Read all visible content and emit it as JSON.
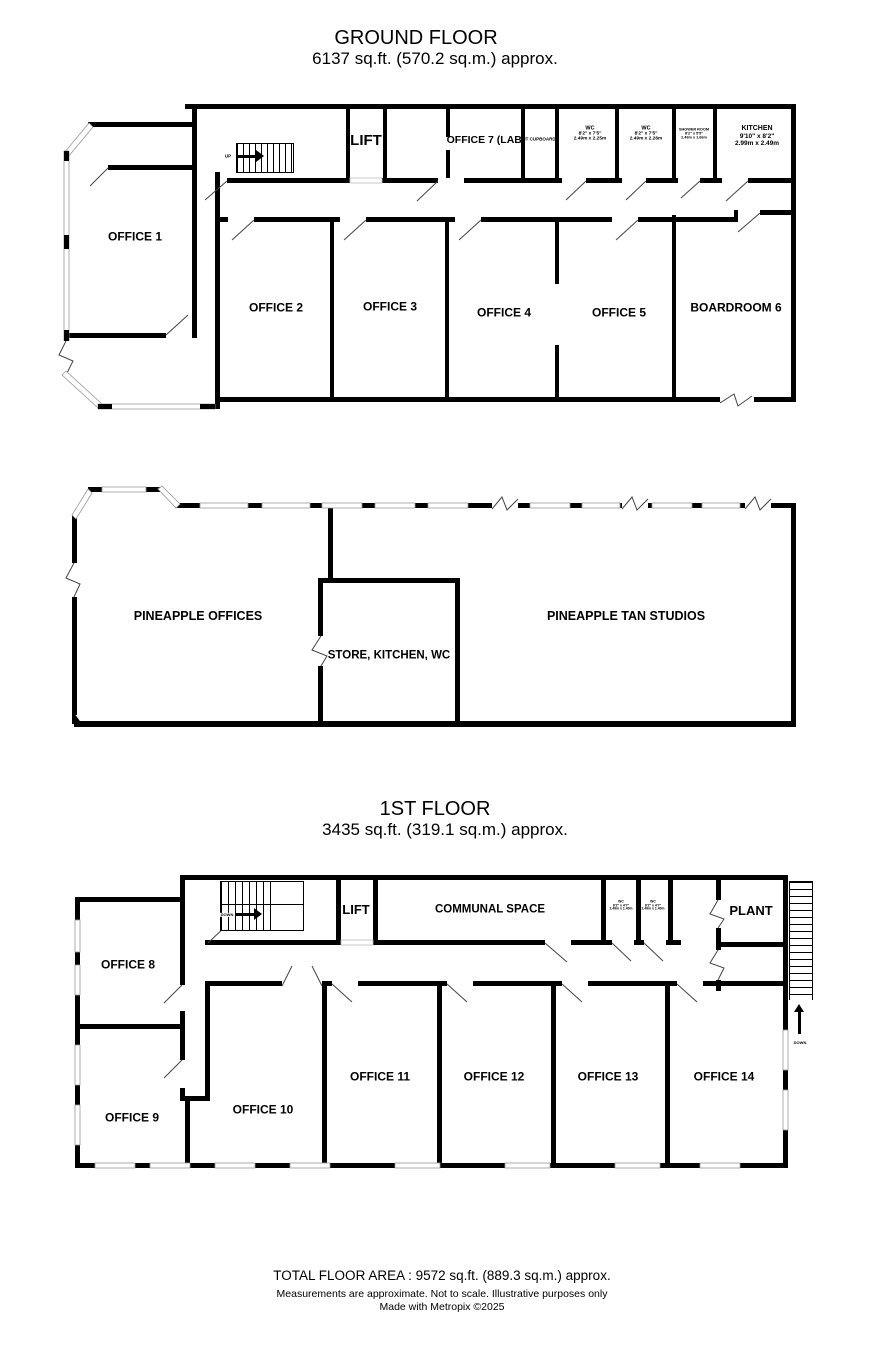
{
  "page": {
    "background": "#ffffff",
    "wall_color": "#000000"
  },
  "ground_floor": {
    "title": "GROUND FLOOR",
    "subtitle": "6137 sq.ft. (570.2 sq.m.) approx.",
    "stairs_label": "UP",
    "rooms": {
      "office1": "OFFICE 1",
      "office2": "OFFICE 2",
      "office3": "OFFICE 3",
      "office4": "OFFICE 4",
      "office5": "OFFICE 5",
      "boardroom6": "BOARDROOM 6",
      "lift": "LIFT",
      "office7": "OFFICE 7 (LAB)",
      "it_cupboard": "IT CUPBOARD",
      "wc1_name": "WC",
      "wc1_imperial": "8'2\" x 7'5\"",
      "wc1_metric": "2.49m x 2.25m",
      "wc2_name": "WC",
      "wc2_imperial": "8'2\" x 7'5\"",
      "wc2_metric": "2.49m x 2.26m",
      "shower_name": "SHOWER ROOM",
      "shower_imperial": "8'2\" x 5'5\"",
      "shower_metric": "2.49m x 1.66m",
      "kitchen_name": "KITCHEN",
      "kitchen_imperial": "9'10\" x 8'2\"",
      "kitchen_metric": "2.99m x 2.49m"
    }
  },
  "annex": {
    "pineapple_offices": "PINEAPPLE OFFICES",
    "store_kitchen_wc": "STORE, KITCHEN, WC",
    "tan_studios": "PINEAPPLE TAN STUDIOS"
  },
  "first_floor": {
    "title": "1ST FLOOR",
    "subtitle": "3435 sq.ft. (319.1 sq.m.) approx.",
    "stairs_label": "DOWN",
    "fire_escape_label": "DOWN",
    "rooms": {
      "office8": "OFFICE 8",
      "office9": "OFFICE 9",
      "office10": "OFFICE 10",
      "office11": "OFFICE 11",
      "office12": "OFFICE 12",
      "office13": "OFFICE 13",
      "office14": "OFFICE 14",
      "lift": "LIFT",
      "communal": "COMMUNAL SPACE",
      "plant": "PLANT",
      "wca_name": "WC",
      "wca_imperial": "8'2\" x 4'7\"",
      "wca_metric": "2.49m x 1.40m",
      "wcb_name": "WC",
      "wcb_imperial": "8'2\" x 4'7\"",
      "wcb_metric": "2.49m x 1.40m"
    }
  },
  "footer": {
    "total": "TOTAL FLOOR AREA : 9572 sq.ft. (889.3 sq.m.) approx.",
    "disclaimer": "Measurements are approximate.  Not to scale.  Illustrative purposes only",
    "credit": "Made with Metropix ©2025"
  }
}
